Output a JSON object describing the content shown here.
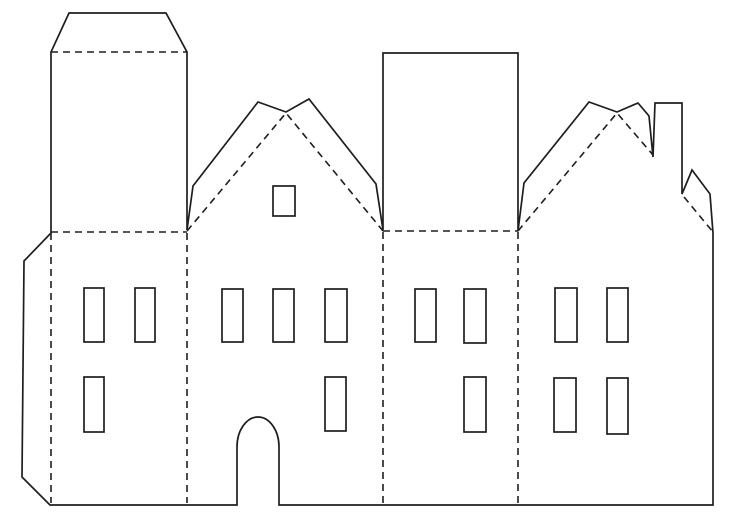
{
  "page": {
    "title": "Paper house cut-and-fold papercraft template",
    "description": "Black-and-white template sheet of four attached house facades: left tower with glue flap, twin-peak gabled house with arched door, tall rectangular block, and right gabled house with chimney. Solid lines are cut lines, dashed lines are fold lines."
  },
  "drawing": {
    "width": 735,
    "height": 520,
    "background_color": "#ffffff",
    "stroke_color": "#1e1e1e",
    "cut_stroke_width": 1.7,
    "fold_stroke_width": 1.6,
    "dash_pattern": "7 5",
    "outline_path": "M 50 505 L 237 505 L 237 447 A 21 30 0 0 1 279 447 L 279 505 L 713 505 L 713 233 L 710 194 L 692 170 L 682 194 L 682 103 L 655 103 L 653 157 L 649 116 L 638 103 L 617 112 L 589 102 L 524 183 L 518 231 L 518 53 L 383 53 L 383 230 L 376 184 L 309 99 L 286 112 L 258 102 L 193 186 L 187 230 L 187 52 L 166 13 L 69 13 L 51 52 L 51 233 L 24 261 L 22 477 Z",
    "fold_lines": [
      {
        "name": "tower-roof-flap-fold",
        "points": "51,52 187,52"
      },
      {
        "name": "tower-base-fold",
        "points": "51,232 187,232"
      },
      {
        "name": "block-base-fold",
        "points": "383,231 518,231"
      },
      {
        "name": "panel-fold-1",
        "points": "51,233 51,503"
      },
      {
        "name": "panel-fold-2",
        "points": "187,233 187,503"
      },
      {
        "name": "panel-fold-3",
        "points": "383,232 383,503"
      },
      {
        "name": "panel-fold-4",
        "points": "518,232 518,503"
      },
      {
        "name": "middle-gable-roof-fold",
        "points": "187,231 286,113 383,231"
      },
      {
        "name": "right-gable-roof-fold",
        "points": "518,231 617,113 653,155"
      },
      {
        "name": "right-eave-fold",
        "points": "684,197 713,232"
      }
    ],
    "window_cutouts": [
      {
        "name": "left-house-window-top-1",
        "x": 84,
        "y": 288,
        "w": 20,
        "h": 54
      },
      {
        "name": "left-house-window-top-2",
        "x": 135,
        "y": 288,
        "w": 20,
        "h": 54
      },
      {
        "name": "left-house-window-bottom-1",
        "x": 84,
        "y": 377,
        "w": 20,
        "h": 55
      },
      {
        "name": "middle-house-attic-window",
        "x": 273,
        "y": 186,
        "w": 22,
        "h": 30
      },
      {
        "name": "middle-house-window-top-1",
        "x": 222,
        "y": 289,
        "w": 21,
        "h": 53
      },
      {
        "name": "middle-house-window-top-2",
        "x": 273,
        "y": 289,
        "w": 21,
        "h": 53
      },
      {
        "name": "middle-house-window-top-3",
        "x": 325,
        "y": 289,
        "w": 22,
        "h": 53
      },
      {
        "name": "middle-house-window-bottom-1",
        "x": 325,
        "y": 377,
        "w": 21,
        "h": 54
      },
      {
        "name": "third-house-window-top-1",
        "x": 415,
        "y": 289,
        "w": 21,
        "h": 53
      },
      {
        "name": "third-house-window-top-2",
        "x": 464,
        "y": 289,
        "w": 22,
        "h": 54
      },
      {
        "name": "third-house-window-bottom-1",
        "x": 464,
        "y": 377,
        "w": 22,
        "h": 55
      },
      {
        "name": "right-house-window-top-1",
        "x": 555,
        "y": 288,
        "w": 22,
        "h": 54
      },
      {
        "name": "right-house-window-top-2",
        "x": 607,
        "y": 288,
        "w": 21,
        "h": 54
      },
      {
        "name": "right-house-window-bottom-1",
        "x": 554,
        "y": 378,
        "w": 22,
        "h": 54
      },
      {
        "name": "right-house-window-bottom-2",
        "x": 607,
        "y": 378,
        "w": 21,
        "h": 56
      }
    ]
  }
}
